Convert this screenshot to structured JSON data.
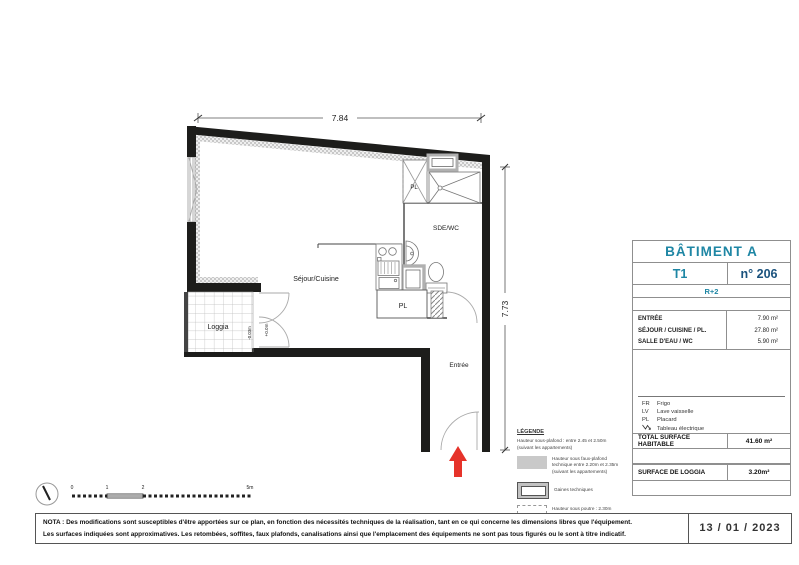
{
  "plan": {
    "dim_top": "7.84",
    "dim_right": "7.73",
    "rooms": {
      "sejour": "Séjour/Cuisine",
      "loggia": "Loggia",
      "sde": "SDE/WC",
      "entree": "Entrée",
      "pl_top": "PL",
      "pl_bottom": "PL"
    },
    "levels": {
      "interior": "+0.0m",
      "loggia": "-0.03m"
    },
    "scale_ticks": [
      "0",
      "1",
      "2",
      "5m"
    ],
    "entrance_arrow_color": "#E6332A"
  },
  "titleblock": {
    "building": "BÂTIMENT A",
    "type": "T1",
    "number": "n° 206",
    "floor": "R+2",
    "areas": [
      {
        "label": "ENTRÉE",
        "value": "7.90 m²"
      },
      {
        "label": "SÉJOUR / CUISINE / PL.",
        "value": "27.80 m²"
      },
      {
        "label": "SALLE D'EAU / WC",
        "value": "5.90 m²"
      }
    ],
    "abbreviations": [
      {
        "abbr": "FR",
        "label": "Frigo"
      },
      {
        "abbr": "LV",
        "label": "Lave vaisselle"
      },
      {
        "abbr": "PL",
        "label": "Placard"
      },
      {
        "abbr": "tableau-electrique-icon",
        "label": "Tableau électrique"
      }
    ],
    "total": {
      "label": "TOTAL SURFACE HABITABLE",
      "value": "41.60 m²"
    },
    "loggia_row": {
      "label": "SURFACE DE LOGGIA",
      "value": "3.20m²"
    },
    "colors": {
      "teal": "#1E86A4",
      "navy": "#1A527D",
      "border": "#8F8F8F"
    }
  },
  "legend": {
    "title": "LÉGENDE",
    "ceiling_note": "Hauteur sous-plafond : entre 2.45 et 2.50m (suivant les appartements)",
    "items": [
      {
        "swatch": "gray-fill-swatch",
        "label": "Hauteur sous faux-plafond technique entre 2.20m et 2.35m (suivant les appartements)"
      },
      {
        "swatch": "duct-swatch",
        "label": "Gaines techniques"
      },
      {
        "swatch": "dashed-swatch",
        "label": "Hauteur sous poutre : 2.30m"
      }
    ]
  },
  "nota": {
    "line1": "NOTA : Des modifications sont susceptibles d'être apportées sur ce plan, en fonction des nécessités techniques de la réalisation, tant en ce qui concerne les dimensions libres que l'équipement.",
    "line2": "Les surfaces indiquées sont approximatives. Les retombées, soffites, faux plafonds, canalisations ainsi que l'emplacement des équipements ne sont pas tous figurés ou le sont à titre indicatif."
  },
  "date": "13 / 01 / 2023"
}
